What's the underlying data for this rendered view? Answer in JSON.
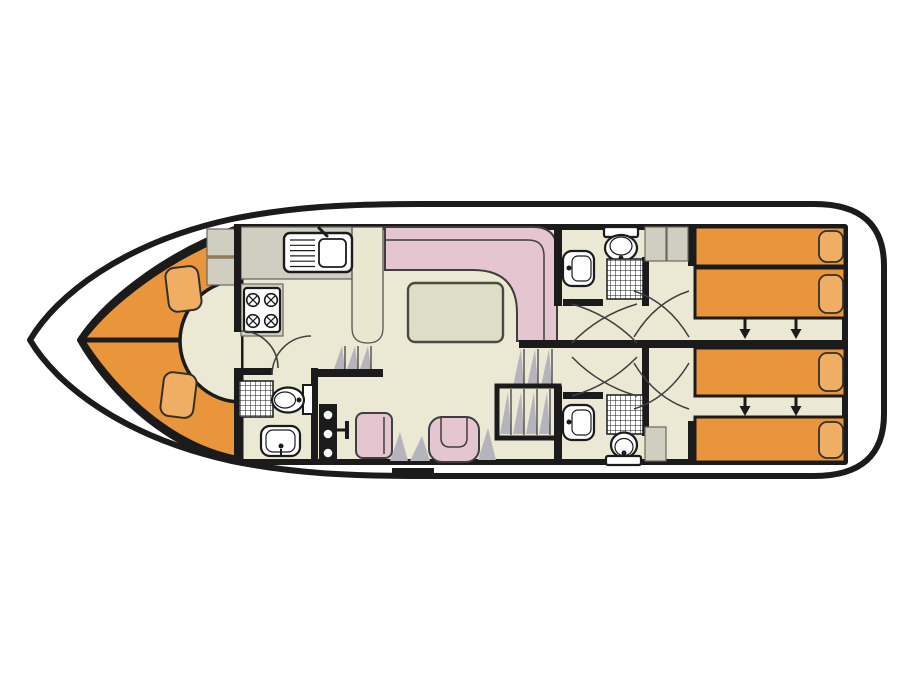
{
  "diagram": {
    "type": "boat-floor-plan",
    "description": "Top-down deck plan of a canal houseboat: V-berth bow cabin, galley, L-shaped saloon, helm station, three shower rooms, two aft twin cabins with sliding beds"
  },
  "palette": {
    "wall": "#1b1b1b",
    "floor": "#ebe9d4",
    "berth_orange": "#e8953c",
    "pillow_orange": "#f0ae65",
    "seat_pink": "#e5c5d0",
    "counter_gray": "#cfcec0",
    "cream_counter": "#e9e7d0",
    "shade_gray": "#b5b4bd",
    "table_fill": "#deddc5",
    "dark_line": "#3f3f3f",
    "bg": "#ffffff"
  },
  "rooms": {
    "bow_cabin": {
      "berths": 2,
      "pillows": 2,
      "cabinets": 2,
      "entry": "semicircular step"
    },
    "galley": {
      "sink": 1,
      "stove_burners": 4,
      "counters": 3
    },
    "saloon": {
      "sofa": "L-shaped",
      "table": 1
    },
    "helm": {
      "console_controls": 3,
      "throttle": 1,
      "seats": 2
    },
    "bathroom_forward": {
      "shower": 1,
      "toilet": 1,
      "sink": 1
    },
    "bathroom_aft_top": {
      "shower": 1,
      "toilet": 1,
      "sink": 1
    },
    "bathroom_aft_bottom": {
      "shower": 1,
      "toilet": 1,
      "sink": 1
    },
    "cabin_aft_top": {
      "beds": 2,
      "pillows": 2,
      "slide_arrows": 2,
      "wardrobes": 2
    },
    "cabin_aft_bottom": {
      "beds": 2,
      "pillows": 2,
      "slide_arrows": 2,
      "wardrobes": 1
    }
  },
  "stairs": {
    "bow_steps": 3,
    "saloon_steps": 3,
    "aft_staircase_treads": 4,
    "boarding_step": 1
  }
}
